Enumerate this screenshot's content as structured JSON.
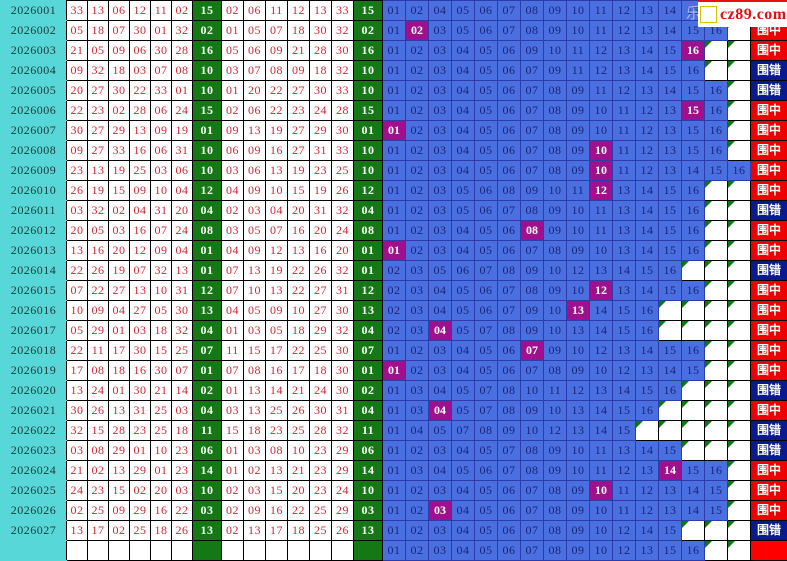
{
  "logo": {
    "partial_char": "乐",
    "text": "cz89.com"
  },
  "result_labels": {
    "hit": "围中",
    "miss": "围错"
  },
  "colors": {
    "cyan": "#57d7d7",
    "green": "#147814",
    "blue": "#4a6fe0",
    "purple": "#a0108e",
    "red_text": "#cc2936",
    "hit_bg": "#ee0000",
    "miss_bg": "#0a1a8e",
    "pending_bg": "#ff0000",
    "yellow": "#ffff00"
  },
  "blue_ball_range": {
    "min": 1,
    "max": 16
  },
  "rows": [
    {
      "period": "2026001",
      "draw": [
        "33",
        "13",
        "06",
        "12",
        "11",
        "02"
      ],
      "blue": "15",
      "sorted": [
        "02",
        "06",
        "11",
        "12",
        "13",
        "33"
      ],
      "candidates": [
        1,
        2,
        4,
        5,
        6,
        7,
        8,
        9,
        10,
        11,
        12,
        13,
        14,
        15,
        16
      ],
      "hit_number": null,
      "result": "hit"
    },
    {
      "period": "2026002",
      "draw": [
        "05",
        "18",
        "07",
        "30",
        "01",
        "32"
      ],
      "blue": "02",
      "sorted": [
        "01",
        "05",
        "07",
        "18",
        "30",
        "32"
      ],
      "candidates": [
        1,
        2,
        3,
        5,
        6,
        7,
        8,
        9,
        10,
        11,
        12,
        13,
        14,
        15,
        16
      ],
      "hit_number": 2,
      "result": "hit"
    },
    {
      "period": "2026003",
      "draw": [
        "21",
        "05",
        "09",
        "06",
        "30",
        "28"
      ],
      "blue": "16",
      "sorted": [
        "05",
        "06",
        "09",
        "21",
        "28",
        "30"
      ],
      "candidates": [
        1,
        2,
        3,
        4,
        5,
        6,
        9,
        10,
        11,
        12,
        13,
        14,
        15,
        16
      ],
      "hit_number": 16,
      "result": "hit"
    },
    {
      "period": "2026004",
      "draw": [
        "09",
        "32",
        "18",
        "03",
        "07",
        "08"
      ],
      "blue": "10",
      "sorted": [
        "03",
        "07",
        "08",
        "09",
        "18",
        "32"
      ],
      "candidates": [
        1,
        2,
        3,
        4,
        5,
        6,
        7,
        9,
        11,
        12,
        13,
        14,
        15,
        16
      ],
      "hit_number": null,
      "result": "miss"
    },
    {
      "period": "2026005",
      "draw": [
        "20",
        "27",
        "30",
        "22",
        "33",
        "01"
      ],
      "blue": "10",
      "sorted": [
        "01",
        "20",
        "22",
        "27",
        "30",
        "33"
      ],
      "candidates": [
        1,
        2,
        3,
        4,
        5,
        6,
        7,
        8,
        9,
        11,
        12,
        13,
        14,
        15,
        16
      ],
      "hit_number": null,
      "result": "miss"
    },
    {
      "period": "2026006",
      "draw": [
        "22",
        "23",
        "02",
        "28",
        "06",
        "24"
      ],
      "blue": "15",
      "sorted": [
        "02",
        "06",
        "22",
        "23",
        "24",
        "28"
      ],
      "candidates": [
        1,
        2,
        3,
        4,
        5,
        6,
        7,
        8,
        9,
        10,
        11,
        12,
        13,
        15,
        16
      ],
      "hit_number": 15,
      "result": "hit"
    },
    {
      "period": "2026007",
      "draw": [
        "30",
        "27",
        "29",
        "13",
        "09",
        "19"
      ],
      "blue": "01",
      "sorted": [
        "09",
        "13",
        "19",
        "27",
        "29",
        "30"
      ],
      "candidates": [
        1,
        2,
        3,
        4,
        5,
        6,
        7,
        8,
        9,
        10,
        11,
        12,
        13,
        15,
        16
      ],
      "hit_number": 1,
      "result": "hit"
    },
    {
      "period": "2026008",
      "draw": [
        "09",
        "27",
        "33",
        "16",
        "06",
        "31"
      ],
      "blue": "10",
      "sorted": [
        "06",
        "09",
        "16",
        "27",
        "31",
        "33"
      ],
      "candidates": [
        1,
        2,
        3,
        4,
        5,
        6,
        7,
        8,
        9,
        10,
        11,
        12,
        13,
        15,
        16
      ],
      "hit_number": 10,
      "result": "hit"
    },
    {
      "period": "2026009",
      "draw": [
        "23",
        "13",
        "19",
        "25",
        "03",
        "06"
      ],
      "blue": "10",
      "sorted": [
        "03",
        "06",
        "13",
        "19",
        "23",
        "25"
      ],
      "candidates": [
        1,
        2,
        3,
        4,
        5,
        6,
        7,
        8,
        9,
        10,
        11,
        12,
        13,
        14,
        15,
        16
      ],
      "hit_number": 10,
      "result": "hit"
    },
    {
      "period": "2026010",
      "draw": [
        "26",
        "19",
        "15",
        "09",
        "10",
        "04"
      ],
      "blue": "12",
      "sorted": [
        "04",
        "09",
        "10",
        "15",
        "19",
        "26"
      ],
      "candidates": [
        1,
        2,
        3,
        5,
        6,
        8,
        9,
        10,
        11,
        12,
        13,
        14,
        15,
        16
      ],
      "hit_number": 12,
      "result": "hit"
    },
    {
      "period": "2026011",
      "draw": [
        "03",
        "32",
        "02",
        "04",
        "31",
        "20"
      ],
      "blue": "04",
      "sorted": [
        "02",
        "03",
        "04",
        "20",
        "31",
        "32"
      ],
      "candidates": [
        1,
        2,
        3,
        5,
        6,
        7,
        8,
        9,
        10,
        11,
        13,
        14,
        15,
        16
      ],
      "hit_number": null,
      "result": "miss"
    },
    {
      "period": "2026012",
      "draw": [
        "20",
        "05",
        "03",
        "16",
        "07",
        "24"
      ],
      "blue": "08",
      "sorted": [
        "03",
        "05",
        "07",
        "16",
        "20",
        "24"
      ],
      "candidates": [
        1,
        2,
        3,
        4,
        5,
        6,
        8,
        9,
        10,
        11,
        13,
        14,
        15,
        16
      ],
      "hit_number": 8,
      "result": "hit"
    },
    {
      "period": "2026013",
      "draw": [
        "13",
        "16",
        "20",
        "12",
        "09",
        "04"
      ],
      "blue": "01",
      "sorted": [
        "04",
        "09",
        "12",
        "13",
        "16",
        "20"
      ],
      "candidates": [
        1,
        2,
        3,
        4,
        5,
        6,
        7,
        8,
        9,
        10,
        13,
        14,
        15,
        16
      ],
      "hit_number": 1,
      "result": "hit"
    },
    {
      "period": "2026014",
      "draw": [
        "22",
        "26",
        "19",
        "07",
        "32",
        "13"
      ],
      "blue": "01",
      "sorted": [
        "07",
        "13",
        "19",
        "22",
        "26",
        "32"
      ],
      "candidates": [
        2,
        3,
        5,
        6,
        7,
        8,
        9,
        10,
        12,
        13,
        14,
        15,
        16
      ],
      "hit_number": null,
      "result": "miss"
    },
    {
      "period": "2026015",
      "draw": [
        "07",
        "22",
        "27",
        "13",
        "10",
        "31"
      ],
      "blue": "12",
      "sorted": [
        "07",
        "10",
        "13",
        "22",
        "27",
        "31"
      ],
      "candidates": [
        2,
        3,
        4,
        5,
        6,
        7,
        8,
        9,
        10,
        12,
        13,
        14,
        15,
        16
      ],
      "hit_number": 12,
      "result": "hit"
    },
    {
      "period": "2026016",
      "draw": [
        "10",
        "09",
        "04",
        "27",
        "05",
        "30"
      ],
      "blue": "13",
      "sorted": [
        "04",
        "05",
        "09",
        "10",
        "27",
        "30"
      ],
      "candidates": [
        2,
        3,
        4,
        5,
        6,
        7,
        9,
        10,
        13,
        14,
        15,
        16
      ],
      "hit_number": 13,
      "result": "hit"
    },
    {
      "period": "2026017",
      "draw": [
        "05",
        "29",
        "01",
        "03",
        "18",
        "32"
      ],
      "blue": "04",
      "sorted": [
        "01",
        "03",
        "05",
        "18",
        "29",
        "32"
      ],
      "candidates": [
        2,
        3,
        4,
        5,
        7,
        8,
        9,
        10,
        13,
        14,
        15,
        16
      ],
      "hit_number": 4,
      "result": "hit"
    },
    {
      "period": "2026018",
      "draw": [
        "22",
        "11",
        "17",
        "30",
        "15",
        "25"
      ],
      "blue": "07",
      "sorted": [
        "11",
        "15",
        "17",
        "22",
        "25",
        "30"
      ],
      "candidates": [
        1,
        2,
        3,
        4,
        5,
        6,
        7,
        9,
        10,
        12,
        13,
        14,
        15,
        16
      ],
      "hit_number": 7,
      "result": "hit"
    },
    {
      "period": "2026019",
      "draw": [
        "17",
        "08",
        "18",
        "16",
        "30",
        "07"
      ],
      "blue": "01",
      "sorted": [
        "07",
        "08",
        "16",
        "17",
        "18",
        "30"
      ],
      "candidates": [
        1,
        2,
        3,
        4,
        5,
        6,
        7,
        8,
        9,
        10,
        12,
        13,
        14,
        15
      ],
      "hit_number": 1,
      "result": "hit"
    },
    {
      "period": "2026020",
      "draw": [
        "13",
        "24",
        "01",
        "30",
        "21",
        "14"
      ],
      "blue": "02",
      "sorted": [
        "01",
        "13",
        "14",
        "21",
        "24",
        "30"
      ],
      "candidates": [
        1,
        3,
        4,
        5,
        7,
        8,
        10,
        11,
        12,
        13,
        14,
        15,
        16
      ],
      "hit_number": null,
      "result": "miss"
    },
    {
      "period": "2026021",
      "draw": [
        "30",
        "26",
        "13",
        "31",
        "25",
        "03"
      ],
      "blue": "04",
      "sorted": [
        "03",
        "13",
        "25",
        "26",
        "30",
        "31"
      ],
      "candidates": [
        1,
        3,
        4,
        5,
        7,
        8,
        9,
        10,
        13,
        14,
        15,
        16
      ],
      "hit_number": 4,
      "result": "hit"
    },
    {
      "period": "2026022",
      "draw": [
        "32",
        "15",
        "28",
        "23",
        "25",
        "18"
      ],
      "blue": "11",
      "sorted": [
        "15",
        "18",
        "23",
        "25",
        "28",
        "32"
      ],
      "candidates": [
        1,
        4,
        5,
        7,
        8,
        9,
        10,
        12,
        13,
        14,
        15
      ],
      "hit_number": null,
      "result": "miss"
    },
    {
      "period": "2026023",
      "draw": [
        "03",
        "08",
        "29",
        "01",
        "10",
        "23"
      ],
      "blue": "06",
      "sorted": [
        "01",
        "03",
        "08",
        "10",
        "23",
        "29"
      ],
      "candidates": [
        1,
        2,
        3,
        4,
        5,
        7,
        8,
        9,
        10,
        11,
        13,
        14,
        15
      ],
      "hit_number": null,
      "result": "miss"
    },
    {
      "period": "2026024",
      "draw": [
        "21",
        "02",
        "13",
        "29",
        "01",
        "23"
      ],
      "blue": "14",
      "sorted": [
        "01",
        "02",
        "13",
        "21",
        "23",
        "29"
      ],
      "candidates": [
        1,
        3,
        4,
        5,
        6,
        7,
        8,
        9,
        10,
        11,
        12,
        13,
        14,
        15,
        16
      ],
      "hit_number": 14,
      "result": "hit"
    },
    {
      "period": "2026025",
      "draw": [
        "24",
        "23",
        "15",
        "02",
        "20",
        "03"
      ],
      "blue": "10",
      "sorted": [
        "02",
        "03",
        "15",
        "20",
        "23",
        "24"
      ],
      "candidates": [
        1,
        2,
        3,
        4,
        5,
        6,
        7,
        8,
        9,
        10,
        11,
        12,
        13,
        14,
        15
      ],
      "hit_number": 10,
      "result": "hit"
    },
    {
      "period": "2026026",
      "draw": [
        "02",
        "25",
        "09",
        "29",
        "16",
        "22"
      ],
      "blue": "03",
      "sorted": [
        "02",
        "09",
        "16",
        "22",
        "25",
        "29"
      ],
      "candidates": [
        1,
        2,
        3,
        4,
        5,
        6,
        7,
        8,
        9,
        10,
        11,
        12,
        13,
        14,
        15
      ],
      "hit_number": 3,
      "result": "hit"
    },
    {
      "period": "2026027",
      "draw": [
        "13",
        "17",
        "02",
        "25",
        "18",
        "26"
      ],
      "blue": "13",
      "sorted": [
        "02",
        "13",
        "17",
        "18",
        "25",
        "26"
      ],
      "candidates": [
        1,
        2,
        3,
        4,
        5,
        6,
        7,
        8,
        9,
        10,
        12,
        14,
        15
      ],
      "hit_number": null,
      "result": "miss"
    }
  ],
  "footer": {
    "candidates": [
      1,
      2,
      3,
      4,
      5,
      6,
      7,
      8,
      9,
      10,
      12,
      13,
      15,
      16
    ],
    "result": "pending"
  }
}
